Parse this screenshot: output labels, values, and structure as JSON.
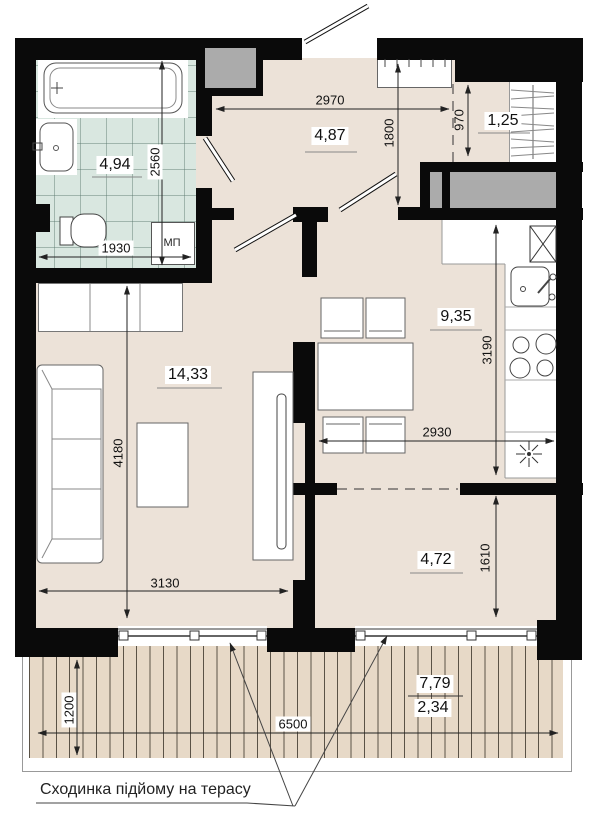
{
  "note": "Сходинка підйому на терасу",
  "labels": {
    "washing_machine": "МП"
  },
  "areas": {
    "bathroom": "4,94",
    "hallway": "4,87",
    "closet": "1,25",
    "kitchen": "9,35",
    "living": "14,33",
    "room": "4,72",
    "terrace": "7,79",
    "terrace_reduced": "2,34"
  },
  "dims": {
    "hall_width": "2970",
    "hall_depth": "1800",
    "closet_width": "970",
    "bath_depth": "2560",
    "bath_width": "1930",
    "living_depth": "4180",
    "living_width": "3130",
    "kitchen_depth": "3190",
    "kitchen_width": "2930",
    "room_depth": "1610",
    "terrace_depth": "1200",
    "terrace_width": "6500"
  },
  "colors": {
    "floor": "#ece2d8",
    "tile": "#d9e7e0",
    "deck": "#e7d9c7",
    "shaft": "#ababab",
    "wall": "#0a0a0a"
  }
}
